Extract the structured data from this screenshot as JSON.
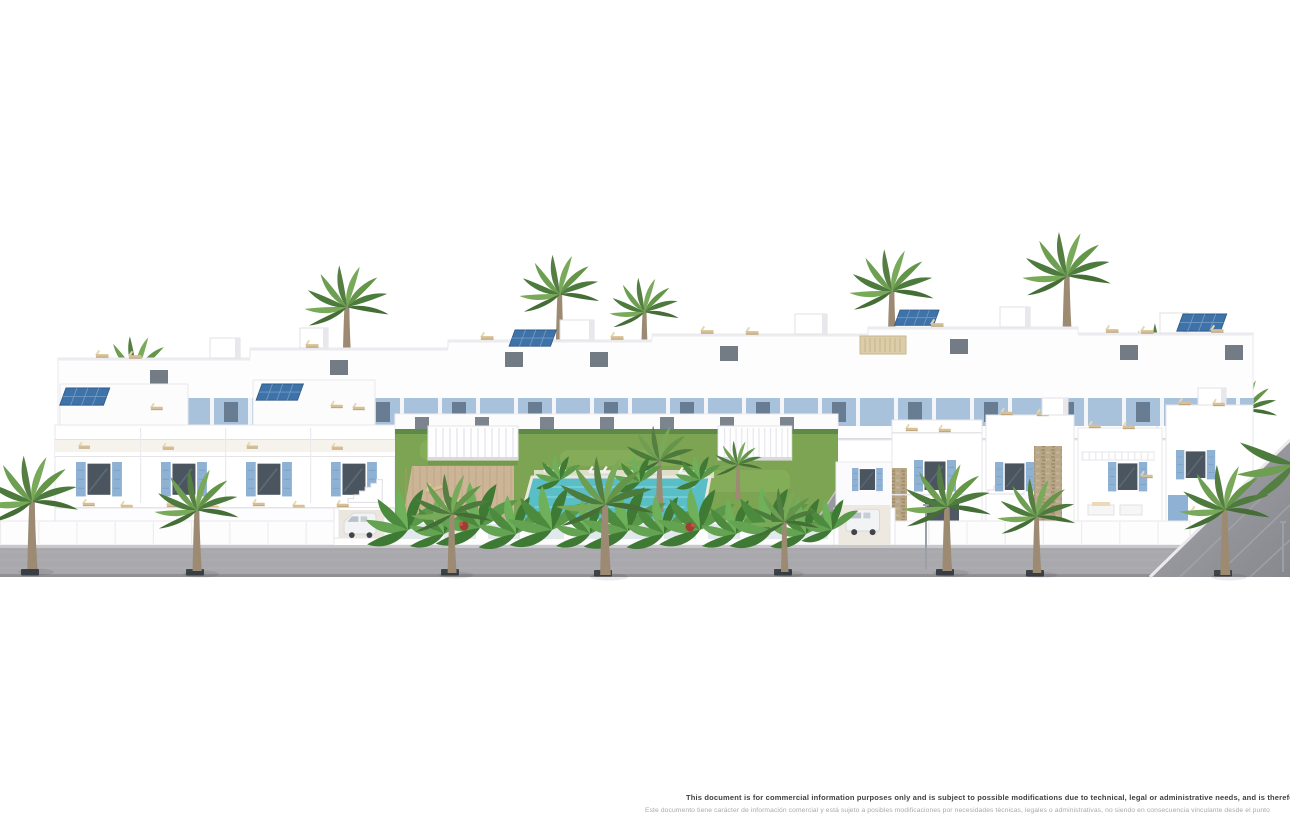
{
  "image": {
    "type": "architectural-render",
    "description": "Street elevation render of a white Mediterranean residential development: rear apartment row with roof terraces and solar panels, mid row with blue-shuttered windows, left townhouse block, central communal garden with pool and pergolas, right detached villas with external stairs, access ramps, palm-lined sidewalk"
  },
  "disclaimer": {
    "en": "This document is for commercial information purposes only and is subject to possible modifications due to technical, legal or administrative needs, and is therefore not co",
    "es": "Este documento tiene carácter de información comercial y está sujeto a posibles modificaciones por necesidades técnicas, legales o administrativas, no siendo en consecuencia vinculante desde el punto"
  },
  "palette": {
    "background": "#ffffff",
    "building_white": "#fdfdfe",
    "shutter_blue": "#8fb2d4",
    "window_glass": "#4a555f",
    "solar_panel_blue": "#3f72a8",
    "lawn_green": "#7da452",
    "palm_green": "#659549",
    "pool_turquoise": "#59bec6",
    "deck_wood": "#cbb596",
    "stone_beige": "#b7a687",
    "sidewalk_gray": "#a9a9ad",
    "lounger_beige": "#d8c094",
    "grate_dark": "#3e434a",
    "red_bush": "#a43c34"
  },
  "scene": {
    "blocks": [
      "rear apartment row with roof terraces",
      "mid row with blue-shuttered windows",
      "left townhouse block with ground terraces",
      "central communal garden with pool",
      "right detached villa block with external stairs",
      "access ramps at right"
    ],
    "features": {
      "street_palm_trees": 8,
      "background_palm_trees": 8,
      "solar_panels": 5,
      "pool_loungers_white": 8,
      "parked_vans": 2,
      "tree_grates": 8,
      "street_lamps": 2,
      "pergolas": 3,
      "red_flower_bushes": 2,
      "small_private_pool": 1
    }
  }
}
